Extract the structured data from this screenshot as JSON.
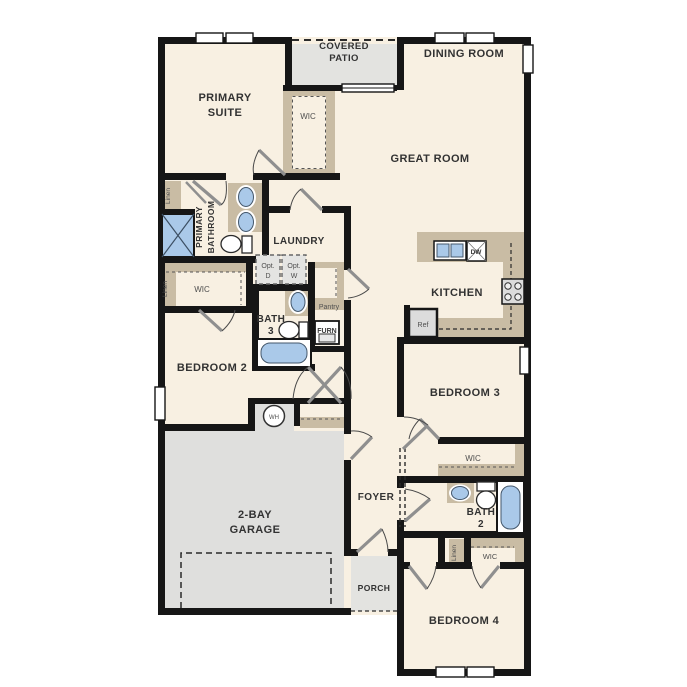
{
  "colors": {
    "floor": "#f8f0e2",
    "patio_gray": "#e3e3e0",
    "garage_gray": "#dfdfdd",
    "counter_tan": "#c9bca4",
    "wall_black": "#161616",
    "fixture_blue": "#aac9e9",
    "label_dark": "#323232"
  },
  "rooms": {
    "covered_patio": {
      "line1": "COVERED",
      "line2": "PATIO"
    },
    "dining_room": {
      "label": "DINING ROOM"
    },
    "great_room": {
      "label": "GREAT ROOM"
    },
    "primary_suite": {
      "line1": "PRIMARY",
      "line2": "SUITE"
    },
    "primary_wic": {
      "label": "WIC"
    },
    "primary_bathroom": {
      "line1": "PRIMARY",
      "line2": "BATHROOM"
    },
    "laundry": {
      "label": "LAUNDRY"
    },
    "kitchen": {
      "label": "KITCHEN"
    },
    "bath_3": {
      "line1": "BATH",
      "line2": "3"
    },
    "bedroom_2": {
      "label": "BEDROOM 2"
    },
    "bedroom_2_wic": {
      "label": "WIC"
    },
    "garage": {
      "line1": "2-BAY",
      "line2": "GARAGE"
    },
    "foyer": {
      "label": "FOYER"
    },
    "porch": {
      "label": "PORCH"
    },
    "bedroom_3": {
      "label": "BEDROOM 3"
    },
    "bedroom_3_wic": {
      "label": "WIC"
    },
    "bath_2": {
      "line1": "BATH",
      "line2": "2"
    },
    "bedroom_4_wic": {
      "label": "WIC"
    },
    "bedroom_4": {
      "label": "BEDROOM 4"
    }
  },
  "fixtures": {
    "linen_primary_bath": "Linen",
    "linen_bedroom2_wic": "Linen",
    "linen_hall": "Linen",
    "opt_dryer": {
      "line1": "Opt.",
      "line2": "D"
    },
    "opt_washer": {
      "line1": "Opt.",
      "line2": "W"
    },
    "pantry": "Pantry",
    "dishwasher": "DW",
    "refrigerator": "Ref",
    "furnace": "FURN",
    "water_heater": "WH"
  }
}
